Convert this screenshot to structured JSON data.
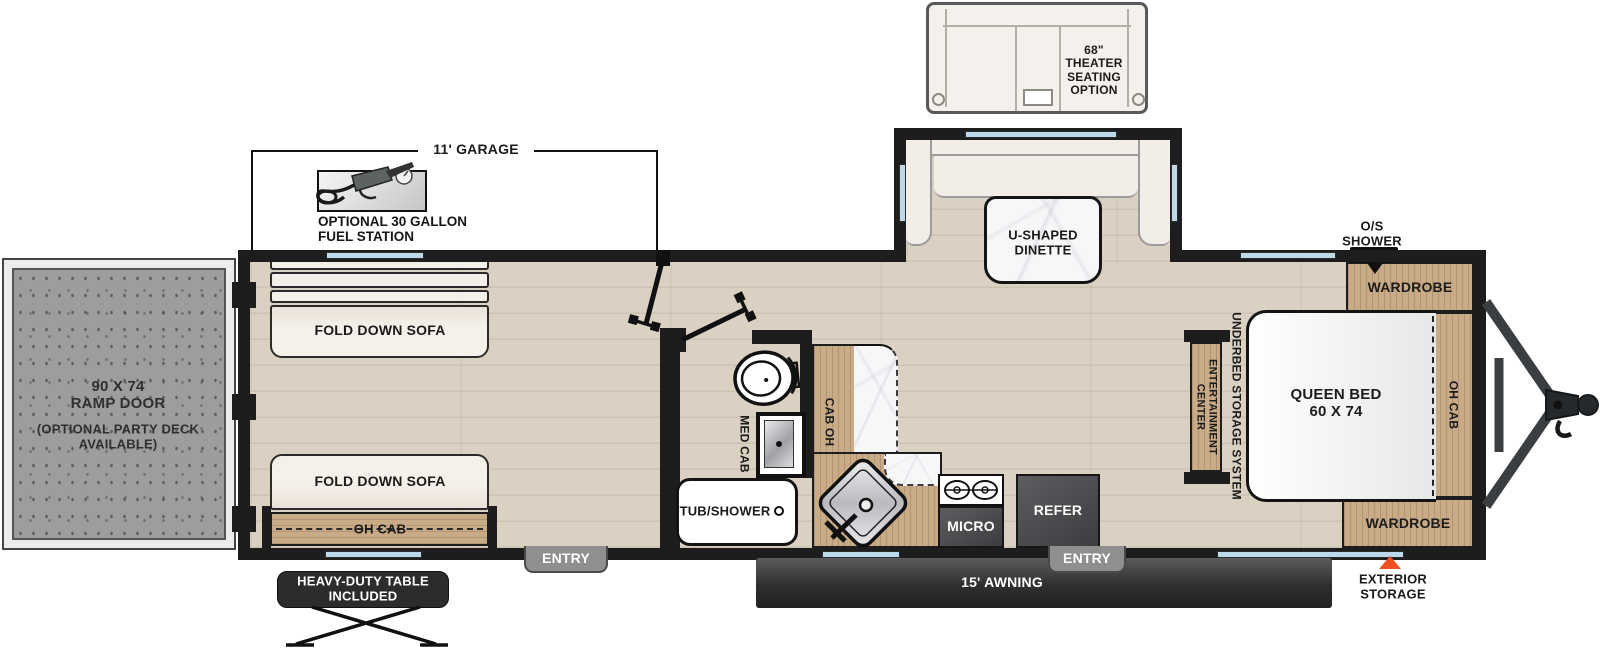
{
  "colors": {
    "wall": "#1d1d1d",
    "window_blue": "#bcd9ec",
    "wood": "#c9ab88",
    "floor": "#dad1c2",
    "accent_orange": "#f04e23"
  },
  "options": {
    "theater_seating": "68\"\nTHEATER\nSEATING\nOPTION",
    "fuel_station": "OPTIONAL 30 GALLON\nFUEL STATION",
    "table_included": "HEAVY-DUTY TABLE\nINCLUDED"
  },
  "dimensions": {
    "garage": "11' GARAGE"
  },
  "exterior": {
    "awning": "15' AWNING",
    "entry_garage": "ENTRY",
    "entry_main": "ENTRY",
    "exterior_storage": "EXTERIOR\nSTORAGE",
    "os_shower": "O/S\nSHOWER",
    "ramp_door": "90 X 74\nRAMP DOOR",
    "ramp_door_option": "(OPTIONAL PARTY DECK\nAVAILABLE)"
  },
  "furniture": {
    "dinette": "U-SHAPED\nDINETTE",
    "fold_down_sofa_top": "FOLD DOWN SOFA",
    "fold_down_sofa_bottom": "FOLD DOWN SOFA",
    "oh_cab_garage": "OH CAB",
    "tub_shower": "TUB/SHOWER",
    "med_cab": "MED CAB",
    "cab_oh": "CAB OH",
    "micro": "MICRO",
    "refer": "REFER",
    "queen_bed": "QUEEN BED\n60 X 74",
    "underbed_storage": "UNDERBED STORAGE SYSTEM",
    "entertainment_center": "ENTERTAINMENT\nCENTER",
    "wardrobe_top": "WARDROBE",
    "wardrobe_bottom": "WARDROBE",
    "oh_cab_bedroom": "OH CAB"
  }
}
